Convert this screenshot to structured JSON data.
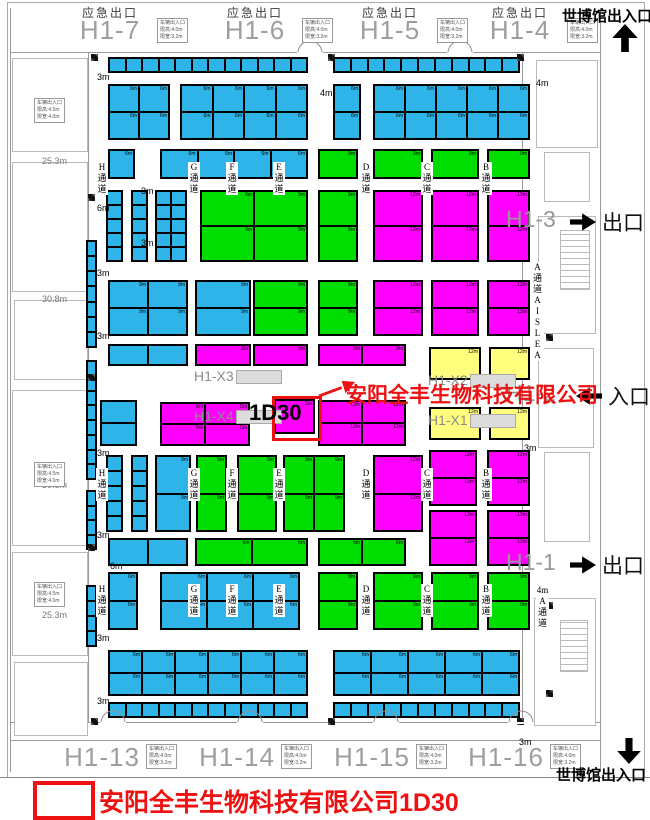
{
  "map": {
    "title": "展馆平面图",
    "expo_top": "世博馆出入口",
    "expo_bottom": "世博馆出入口",
    "legend": {
      "company": "安阳全丰生物科技有限公司1D30"
    },
    "highlight": {
      "booth": "1D30",
      "company": "安阳全丰生物科技有限公司",
      "size": "5m"
    },
    "colors": {
      "cyan": "#2fb4e9",
      "green": "#00dd00",
      "magenta": "#ff00ff",
      "yellow": "#ffff7d",
      "red": "#ed1111",
      "wall": "#999999"
    },
    "gate_info": [
      "车辆出入口",
      "限高:4.0m",
      "限宽:3.2m"
    ],
    "side_info": [
      "车辆出入口",
      "限高:4.5m",
      "限宽:4.0m"
    ],
    "emergency_exit": "应急出口",
    "top_halls": [
      {
        "name": "H1-7",
        "cx": 110
      },
      {
        "name": "H1-6",
        "cx": 255
      },
      {
        "name": "H1-5",
        "cx": 390
      },
      {
        "name": "H1-4",
        "cx": 520
      }
    ],
    "bottom_halls": [
      {
        "name": "H1-13",
        "cx": 102
      },
      {
        "name": "H1-14",
        "cx": 237
      },
      {
        "name": "H1-15",
        "cx": 372
      },
      {
        "name": "H1-16",
        "cx": 506
      }
    ],
    "right_gates": [
      {
        "hall": "H1-3",
        "word": "出口",
        "dir": "right",
        "y": 206
      },
      {
        "hall": "H1-2",
        "word": "入口",
        "dir": "left",
        "y": 380
      },
      {
        "hall": "H1-1",
        "word": "出口",
        "dir": "right",
        "y": 549
      }
    ],
    "measurements": [
      {
        "t": "25.3m",
        "x": 42,
        "y": 156
      },
      {
        "t": "30.8m",
        "x": 42,
        "y": 294
      },
      {
        "t": "30.8m",
        "x": 42,
        "y": 480
      },
      {
        "t": "25.3m",
        "x": 42,
        "y": 610
      }
    ],
    "size_labels": [
      {
        "t": "3m",
        "x": 97,
        "y": 72
      },
      {
        "t": "6m",
        "x": 97,
        "y": 203
      },
      {
        "t": "3m",
        "x": 97,
        "y": 268
      },
      {
        "t": "3m",
        "x": 97,
        "y": 331
      },
      {
        "t": "3m",
        "x": 97,
        "y": 448
      },
      {
        "t": "3m",
        "x": 97,
        "y": 530
      },
      {
        "t": "6m",
        "x": 110,
        "y": 561
      },
      {
        "t": "3m",
        "x": 97,
        "y": 633
      },
      {
        "t": "3m",
        "x": 97,
        "y": 696
      },
      {
        "t": "4m",
        "x": 320,
        "y": 88
      },
      {
        "t": "4m",
        "x": 536,
        "y": 78
      },
      {
        "t": "3m",
        "x": 524,
        "y": 443
      },
      {
        "t": "3m",
        "x": 519,
        "y": 737
      },
      {
        "t": "3m",
        "x": 141,
        "y": 186
      },
      {
        "t": "3m",
        "x": 141,
        "y": 238
      }
    ],
    "aisle_letters": [
      "H",
      "G",
      "F",
      "E",
      "D",
      "C",
      "B"
    ],
    "aisle_word": [
      "通",
      "道"
    ],
    "aisle_letter_xs": [
      97,
      189,
      227,
      274,
      361,
      422,
      481
    ],
    "aisle_letter_rows": [
      162,
      468,
      584
    ],
    "a_aisle": {
      "x": 531,
      "y": 262,
      "chars": [
        "A",
        "通",
        "道",
        "A",
        "I",
        "S",
        "L",
        "E",
        "A"
      ]
    },
    "a_aisle2": {
      "x": 536,
      "y": 585,
      "chars": [
        "4m",
        "A",
        "通",
        "道"
      ]
    },
    "hx_labels": [
      {
        "t": "H1-X3",
        "x": 194,
        "y": 368,
        "bx": 236,
        "by": 370
      },
      {
        "t": "H1-X2",
        "x": 428,
        "y": 372,
        "bx": 470,
        "by": 374
      },
      {
        "t": "H1-X4",
        "x": 194,
        "y": 408,
        "bx": 236,
        "by": 410
      },
      {
        "t": "H1-X1",
        "x": 428,
        "y": 412,
        "bx": 470,
        "by": 414
      }
    ],
    "blocks": [
      [
        108,
        57,
        200,
        16,
        "cyan",
        12,
        1,
        ""
      ],
      [
        333,
        57,
        187,
        16,
        "cyan",
        11,
        1,
        ""
      ],
      [
        108,
        84,
        62,
        56,
        "cyan",
        2,
        2,
        "6m"
      ],
      [
        180,
        84,
        128,
        56,
        "cyan",
        4,
        2,
        "6m"
      ],
      [
        333,
        84,
        28,
        56,
        "cyan",
        1,
        2,
        "6m"
      ],
      [
        373,
        84,
        157,
        56,
        "cyan",
        5,
        2,
        "6m"
      ],
      [
        108,
        149,
        27,
        30,
        "cyan",
        1,
        1,
        "6m"
      ],
      [
        160,
        149,
        148,
        30,
        "cyan",
        4,
        1,
        "6m"
      ],
      [
        318,
        149,
        40,
        30,
        "green",
        1,
        1,
        "9m"
      ],
      [
        373,
        149,
        50,
        30,
        "green",
        1,
        1,
        "9m"
      ],
      [
        431,
        149,
        48,
        30,
        "green",
        1,
        1,
        "9m"
      ],
      [
        487,
        149,
        43,
        30,
        "green",
        1,
        1,
        "9m"
      ],
      [
        106,
        190,
        17,
        72,
        "cyan",
        1,
        5,
        ""
      ],
      [
        131,
        190,
        17,
        72,
        "cyan",
        1,
        5,
        ""
      ],
      [
        155,
        190,
        32,
        72,
        "cyan",
        2,
        5,
        ""
      ],
      [
        200,
        190,
        108,
        72,
        "green",
        2,
        2,
        "9m"
      ],
      [
        318,
        190,
        40,
        72,
        "green",
        1,
        2,
        "9m"
      ],
      [
        373,
        190,
        50,
        72,
        "magenta",
        1,
        2,
        "12m"
      ],
      [
        431,
        190,
        48,
        72,
        "magenta",
        1,
        2,
        "12m"
      ],
      [
        487,
        190,
        43,
        72,
        "magenta",
        1,
        2,
        "12m"
      ],
      [
        108,
        280,
        80,
        56,
        "cyan",
        2,
        2,
        "9m"
      ],
      [
        195,
        280,
        56,
        56,
        "cyan",
        1,
        2,
        "9m"
      ],
      [
        253,
        280,
        55,
        56,
        "green",
        1,
        2,
        "9m"
      ],
      [
        318,
        280,
        40,
        56,
        "green",
        1,
        2,
        "9m"
      ],
      [
        373,
        280,
        50,
        56,
        "magenta",
        1,
        2,
        "12m"
      ],
      [
        431,
        280,
        48,
        56,
        "magenta",
        1,
        2,
        "12m"
      ],
      [
        487,
        280,
        43,
        56,
        "magenta",
        1,
        2,
        "12m"
      ],
      [
        108,
        344,
        80,
        22,
        "cyan",
        2,
        1,
        ""
      ],
      [
        195,
        344,
        56,
        22,
        "magenta",
        1,
        1,
        "9m"
      ],
      [
        253,
        344,
        55,
        22,
        "magenta",
        1,
        1,
        "9m"
      ],
      [
        318,
        344,
        88,
        22,
        "magenta",
        2,
        1,
        "9m"
      ],
      [
        429,
        347,
        52,
        33,
        "yellow",
        1,
        1,
        "12m"
      ],
      [
        489,
        347,
        41,
        33,
        "yellow",
        1,
        1,
        "12m"
      ],
      [
        100,
        400,
        37,
        46,
        "cyan",
        1,
        2,
        ""
      ],
      [
        160,
        402,
        90,
        44,
        "magenta",
        2,
        2,
        "5m"
      ],
      [
        318,
        400,
        88,
        46,
        "magenta",
        2,
        2,
        "12m"
      ],
      [
        429,
        407,
        52,
        33,
        "yellow",
        1,
        1,
        "12m"
      ],
      [
        489,
        407,
        41,
        33,
        "yellow",
        1,
        1,
        "12m"
      ],
      [
        106,
        455,
        17,
        77,
        "cyan",
        1,
        5,
        ""
      ],
      [
        131,
        455,
        17,
        77,
        "cyan",
        1,
        5,
        ""
      ],
      [
        155,
        455,
        36,
        77,
        "cyan",
        1,
        2,
        "9m"
      ],
      [
        196,
        455,
        31,
        77,
        "green",
        1,
        2,
        "9m"
      ],
      [
        237,
        455,
        40,
        77,
        "green",
        1,
        2,
        "9m"
      ],
      [
        283,
        455,
        62,
        77,
        "green",
        2,
        2,
        "9m"
      ],
      [
        373,
        455,
        50,
        77,
        "magenta",
        1,
        2,
        "12m"
      ],
      [
        429,
        450,
        48,
        56,
        "magenta",
        1,
        2,
        "12m"
      ],
      [
        487,
        450,
        43,
        56,
        "magenta",
        1,
        2,
        "12m"
      ],
      [
        108,
        538,
        80,
        28,
        "cyan",
        2,
        1,
        ""
      ],
      [
        195,
        538,
        113,
        28,
        "green",
        2,
        1,
        "6m"
      ],
      [
        318,
        538,
        88,
        28,
        "green",
        2,
        1,
        "6m"
      ],
      [
        429,
        510,
        48,
        56,
        "magenta",
        1,
        2,
        "12m"
      ],
      [
        487,
        510,
        43,
        56,
        "magenta",
        1,
        2,
        "12m"
      ],
      [
        108,
        572,
        30,
        58,
        "cyan",
        1,
        2,
        "6m"
      ],
      [
        160,
        572,
        140,
        58,
        "cyan",
        3,
        2,
        "6m"
      ],
      [
        318,
        572,
        40,
        58,
        "green",
        1,
        2,
        "9m"
      ],
      [
        373,
        572,
        50,
        58,
        "green",
        1,
        2,
        "9m"
      ],
      [
        431,
        572,
        48,
        58,
        "green",
        1,
        2,
        "9m"
      ],
      [
        487,
        572,
        43,
        58,
        "green",
        1,
        2,
        "9m"
      ],
      [
        108,
        650,
        200,
        46,
        "cyan",
        6,
        2,
        "6m"
      ],
      [
        333,
        650,
        187,
        46,
        "cyan",
        5,
        2,
        "6m"
      ],
      [
        108,
        702,
        200,
        16,
        "cyan",
        12,
        1,
        ""
      ],
      [
        333,
        702,
        187,
        16,
        "cyan",
        11,
        1,
        ""
      ],
      [
        86,
        240,
        11,
        108,
        "cyan",
        1,
        7,
        ""
      ],
      [
        86,
        360,
        11,
        120,
        "cyan",
        1,
        8,
        ""
      ],
      [
        86,
        490,
        11,
        60,
        "cyan",
        1,
        4,
        ""
      ],
      [
        86,
        585,
        11,
        62,
        "cyan",
        1,
        4,
        ""
      ]
    ],
    "highlight_block": [
      274,
      399,
      41,
      35
    ],
    "pillars": [
      [
        91,
        54
      ],
      [
        328,
        54
      ],
      [
        517,
        54
      ],
      [
        88,
        194
      ],
      [
        88,
        374
      ],
      [
        88,
        544
      ],
      [
        546,
        334
      ],
      [
        546,
        602
      ],
      [
        546,
        690
      ],
      [
        91,
        718
      ],
      [
        328,
        718
      ],
      [
        517,
        718
      ]
    ],
    "doors_top": [
      297,
      447
    ],
    "doors_bottom": [
      100,
      237,
      373,
      508
    ],
    "rooms_left": [
      [
        12,
        58,
        74,
        92
      ],
      [
        12,
        162,
        74,
        128
      ],
      [
        14,
        300,
        72,
        78
      ],
      [
        12,
        390,
        74,
        154
      ],
      [
        12,
        552,
        74,
        102
      ],
      [
        14,
        662,
        72,
        72
      ]
    ],
    "rooms_right": [
      [
        536,
        60,
        60,
        86
      ],
      [
        544,
        152,
        44,
        48
      ],
      [
        538,
        216,
        56,
        116
      ],
      [
        538,
        348,
        54,
        98
      ],
      [
        544,
        452,
        44,
        88
      ],
      [
        534,
        598,
        60,
        126
      ]
    ],
    "stairs": [
      [
        560,
        230,
        28,
        58
      ],
      [
        560,
        620,
        26,
        50
      ]
    ],
    "left_info_y": [
      98,
      462,
      582
    ],
    "walls": {
      "verticals": [
        [
          10,
          8,
          764
        ],
        [
          88,
          52,
          670
        ],
        [
          522,
          52,
          670
        ],
        [
          600,
          8,
          764
        ]
      ],
      "horizontals": [
        [
          52,
          10,
          590
        ],
        [
          722,
          10,
          590
        ],
        [
          740,
          10,
          590
        ]
      ]
    }
  }
}
